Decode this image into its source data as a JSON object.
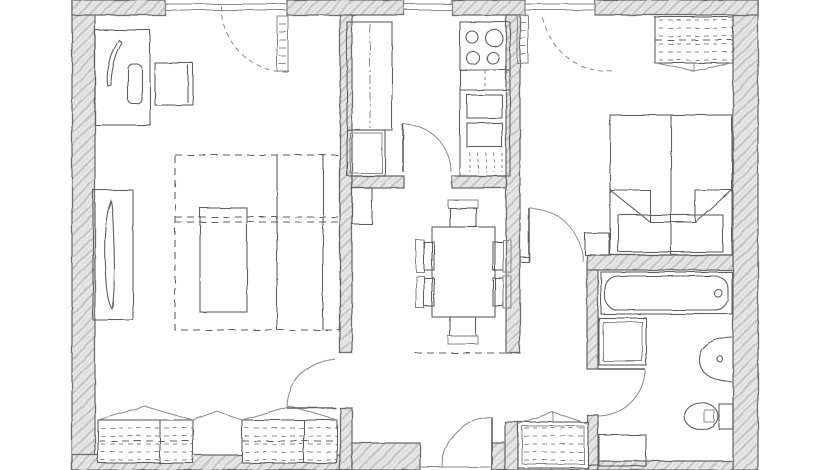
{
  "colors": {
    "background": "#ffffff",
    "wall_fill": "#e8e8e8",
    "wall_hatch": "#c6c6c6",
    "wall_edge": "#6e6e6e",
    "line": "#5f5f5f",
    "soft": "#8a8a8a"
  },
  "plan": {
    "style": "hand-drawn pencil sketch floor plan, monochrome",
    "window_count": 3,
    "door_count": 5
  },
  "rooms": [
    {
      "id": "living-room",
      "furniture": [
        "desk",
        "desk-chair",
        "side-table",
        "tv-cabinet",
        "sofa-bed",
        "coffee-table",
        "wardrobe-left",
        "wardrobe-right"
      ],
      "windows": 1,
      "doors": 1
    },
    {
      "id": "kitchen",
      "furniture": [
        "tall-cabinet",
        "base-cabinet",
        "stove-4-burner",
        "oven-block",
        "sink-cabinet",
        "lower-cabinet"
      ],
      "windows": 1,
      "doors": 1
    },
    {
      "id": "dining-area",
      "furniture": [
        "dining-table",
        "dining-chair",
        "dining-chair",
        "dining-chair",
        "dining-chair",
        "dining-chair",
        "dining-chair",
        "radiator"
      ],
      "windows": 0,
      "doors": 0
    },
    {
      "id": "hallway",
      "furniture": [
        "entrance-door",
        "hall-closet"
      ],
      "windows": 0,
      "doors": 1
    },
    {
      "id": "corridor",
      "furniture": [],
      "windows": 0,
      "doors": 2
    },
    {
      "id": "bedroom",
      "furniture": [
        "double-bed",
        "nightstand",
        "wardrobe"
      ],
      "windows": 1,
      "doors": 1
    },
    {
      "id": "bathroom",
      "furniture": [
        "bathtub",
        "washbasin",
        "toilet",
        "washing-machine",
        "low-cabinet"
      ],
      "windows": 0,
      "doors": 1
    }
  ],
  "doors": [
    {
      "from": "outside",
      "to": "hallway",
      "kind": "entrance-door"
    },
    {
      "from": "hallway",
      "to": "living-room",
      "kind": "hinged-door"
    },
    {
      "from": "dining-area",
      "to": "kitchen",
      "kind": "hinged-door"
    },
    {
      "from": "corridor",
      "to": "bedroom",
      "kind": "hinged-door"
    },
    {
      "from": "corridor",
      "to": "bathroom",
      "kind": "hinged-door"
    }
  ],
  "windows": [
    {
      "room": "living-room",
      "casement_shown": true
    },
    {
      "room": "kitchen",
      "casement_shown": false
    },
    {
      "room": "bedroom",
      "casement_shown": true
    }
  ]
}
